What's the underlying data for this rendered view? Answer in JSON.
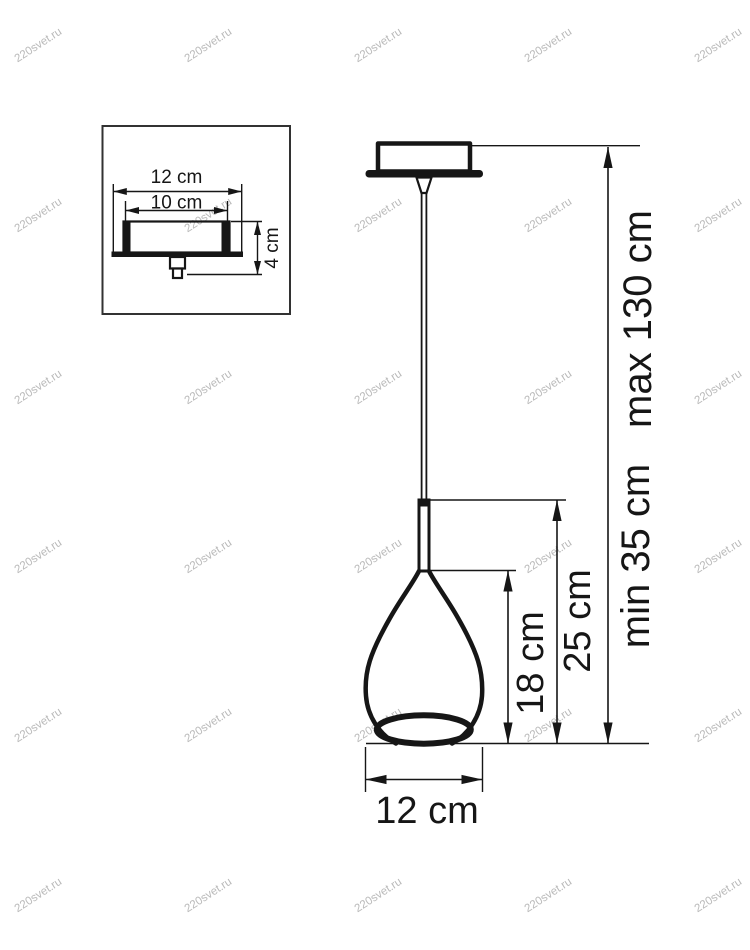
{
  "watermark": {
    "text": "220svet.ru",
    "angle": -33,
    "cols": [
      40,
      210,
      380,
      550,
      720
    ],
    "rows": [
      48,
      218,
      390,
      559,
      728,
      898
    ]
  },
  "inset": {
    "outer_width_label": "12 cm",
    "inner_width_label": "10 cm",
    "height_label": "4 cm"
  },
  "pendant": {
    "shade_height_label": "18 cm",
    "shade_assembly_height_label": "25 cm",
    "suspension_min_label": "min 35 cm",
    "suspension_max_label": "max 130 cm",
    "shade_width_label": "12 cm"
  },
  "colors": {
    "line": "#161616",
    "inset_border": "#323232",
    "watermark": "#b9b9b9",
    "background": "#ffffff"
  }
}
